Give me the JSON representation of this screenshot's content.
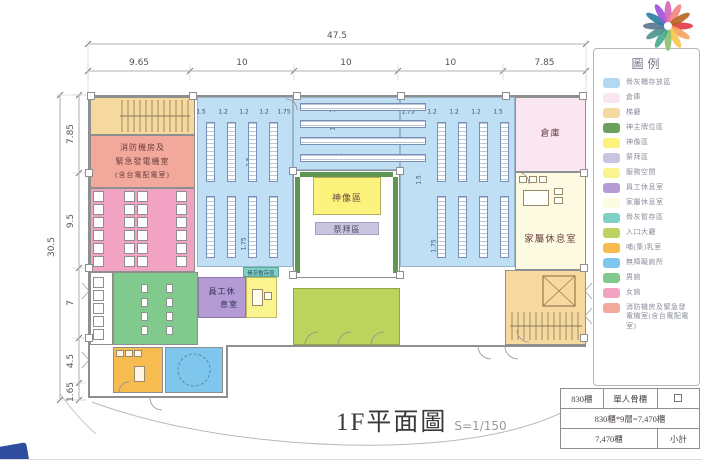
{
  "title": {
    "text": "1F平面圖",
    "scale": "S=1/150"
  },
  "dimensions": {
    "top_total": "47.5",
    "top_segments": [
      "9.65",
      "10",
      "10",
      "10",
      "7.85"
    ],
    "left_total": "30.5",
    "left_segments": [
      "7.85",
      "9.5",
      "7",
      "4.5",
      "1.65"
    ],
    "cabinet_dims_left": [
      "1.5",
      "1.2",
      "1.2",
      "1.2",
      "1.75"
    ],
    "cabinet_dims_right": [
      "1.75",
      "1.2",
      "1.2",
      "1.2",
      "1.5"
    ],
    "cabinet_dims_misc": [
      "1.2",
      "1.2",
      "1.4",
      "1.5",
      "1.75",
      "1.5",
      "1.75"
    ]
  },
  "rooms": {
    "fire_room_lines": [
      "消防機房及",
      "緊急發電機室",
      "(含台電配電室)"
    ],
    "warehouse": "倉庫",
    "family_lounge": "家屬休息室",
    "statue_area": "神像區",
    "worship_area": "祭拜區",
    "staff_lounge_lines": [
      "員工休",
      "息室"
    ],
    "temp_storage": "骨灰暫存區"
  },
  "legend": {
    "title": "圖例",
    "items": [
      {
        "label": "骨灰櫃存放區",
        "color": "#B3D9F2"
      },
      {
        "label": "倉庫",
        "color": "#FAE6F1"
      },
      {
        "label": "梯廳",
        "color": "#F6D99F"
      },
      {
        "label": "神主牌位區",
        "color": "#6CA05C"
      },
      {
        "label": "神像區",
        "color": "#FCF37D"
      },
      {
        "label": "祭拜區",
        "color": "#C8C6DE"
      },
      {
        "label": "服務空間",
        "color": "#FAF48F"
      },
      {
        "label": "員工休息室",
        "color": "#B49BD6"
      },
      {
        "label": "家屬休息室",
        "color": "#FCFAE1"
      },
      {
        "label": "骨灰暫存區",
        "color": "#7FCFC4"
      },
      {
        "label": "入口大廳",
        "color": "#BCD45E"
      },
      {
        "label": "哺(集)乳室",
        "color": "#F6BC4F"
      },
      {
        "label": "無障礙廁所",
        "color": "#7EC6EC"
      },
      {
        "label": "男廁",
        "color": "#82C98E"
      },
      {
        "label": "女廁",
        "color": "#F2A3C4"
      },
      {
        "label": "消防機房及緊急發電機室(含台電配電室)",
        "color": "#F2A89A"
      }
    ]
  },
  "count_table": {
    "r1c1": "830櫃",
    "r1c2": "單人骨櫃",
    "r1c3_symbol": "square-outline",
    "r2": "830櫃*9層=7,470櫃",
    "r3c1": "7,470櫃",
    "r3c2": "小計"
  },
  "colors": {
    "ash_storage": "#BFDFF4",
    "wall": "#8f8f8f",
    "dim_text": "#555555",
    "site_curve": "#b8b8b8"
  }
}
